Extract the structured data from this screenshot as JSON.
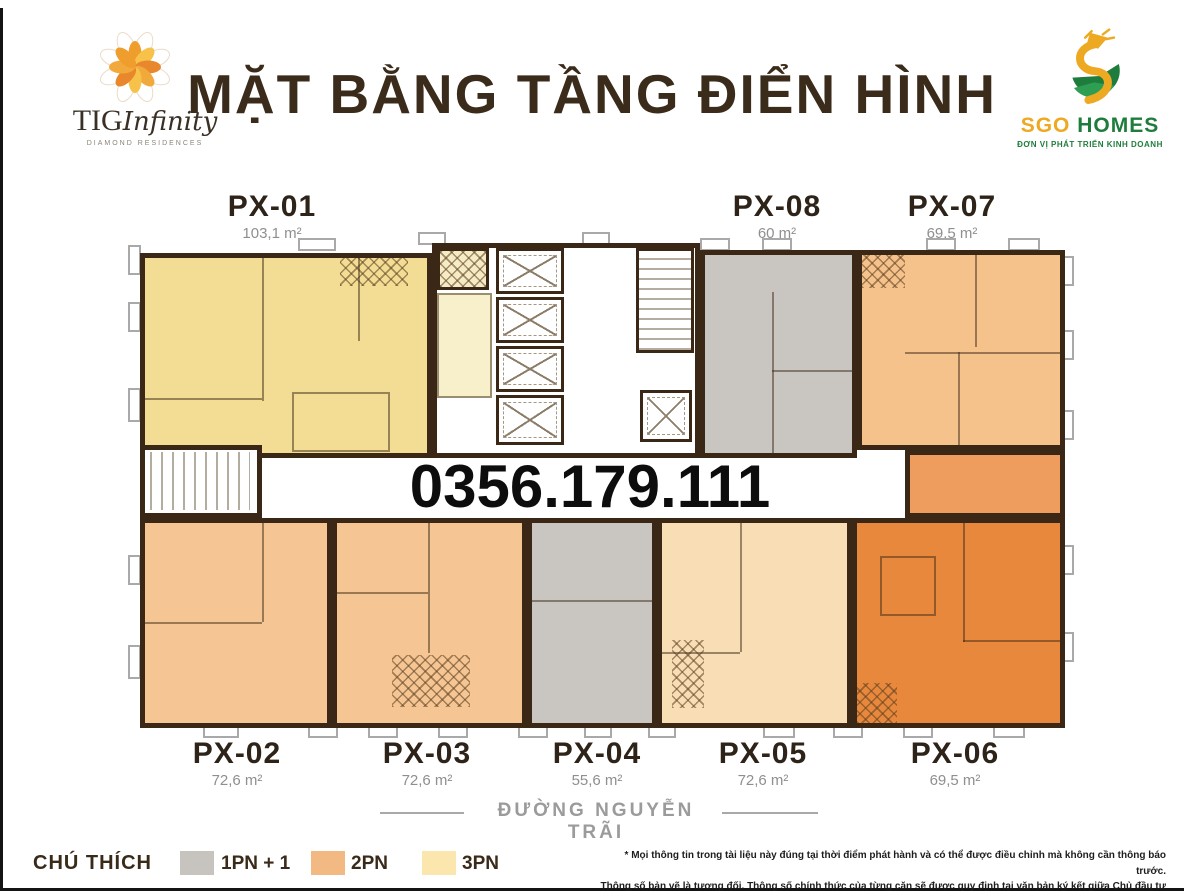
{
  "header": {
    "title": "MẶT BẰNG TẦNG ĐIỂN HÌNH",
    "tig_logo": {
      "name": "TIG",
      "script": "Infinity",
      "tagline": "DIAMOND RESIDENCES"
    },
    "sgo_logo": {
      "name_gold": "SGO",
      "name_green": "HOMES",
      "tagline": "ĐƠN VỊ PHÁT TRIỂN KINH DOANH"
    }
  },
  "hotline": "0356.179.111",
  "street": "ĐƯỜNG NGUYỄN TRÃI",
  "units": [
    {
      "code": "PX-01",
      "area": "103,1 m²",
      "type": "3PN"
    },
    {
      "code": "PX-02",
      "area": "72,6 m²",
      "type": "2PN"
    },
    {
      "code": "PX-03",
      "area": "72,6 m²",
      "type": "2PN"
    },
    {
      "code": "PX-04",
      "area": "55,6 m²",
      "type": "1PN + 1"
    },
    {
      "code": "PX-05",
      "area": "72,6 m²",
      "type": "2PN"
    },
    {
      "code": "PX-06",
      "area": "69,5 m²",
      "type": "2PN"
    },
    {
      "code": "PX-07",
      "area": "69,5 m²",
      "type": "2PN"
    },
    {
      "code": "PX-08",
      "area": "60 m²",
      "type": "1PN + 1"
    }
  ],
  "legend": {
    "label": "CHÚ THÍCH",
    "items": [
      {
        "label": "1PN + 1",
        "color": "#c7c3be"
      },
      {
        "label": "2PN",
        "color": "#f2b983"
      },
      {
        "label": "3PN",
        "color": "#fbe7ad"
      }
    ]
  },
  "disclaimer": {
    "line1": "* Mọi thông tin trong tài liệu này đúng tại thời điểm phát hành và có thể được điều chỉnh mà không cần thông báo trước.",
    "line2": "Thông số bản vẽ là tương đối. Thông số chính thức của từng căn sẽ được quy định tại văn bản ký kết giữa Chủ đầu tư và khách hàng."
  },
  "colors": {
    "wall": "#3a2716",
    "unit_1pn1": "#c9c6c1",
    "unit_2pn": "#f5c693",
    "unit_3pn": "#f3dd94",
    "unit_highlight": "#e8883c",
    "accent_gold": "#eda921",
    "accent_green": "#1e7d3c",
    "title_brown": "#3b2b1b"
  }
}
